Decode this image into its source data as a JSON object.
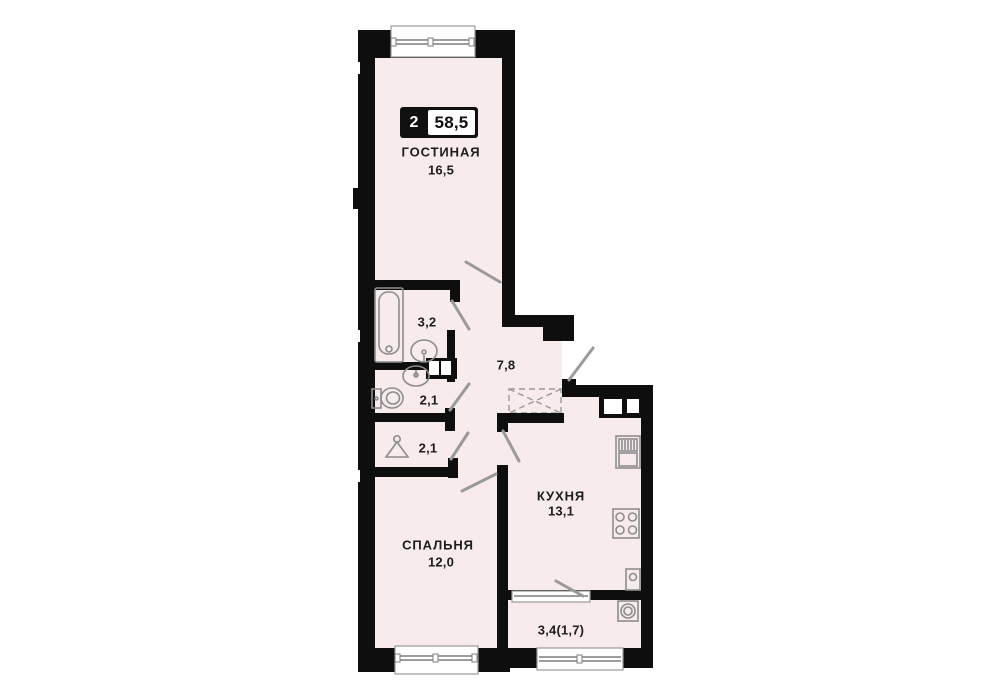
{
  "badge": {
    "rooms": "2",
    "total_area": "58,5"
  },
  "rooms": {
    "living": {
      "name": "ГОСТИНАЯ",
      "area": "16,5"
    },
    "bathroom": {
      "area": "3,2"
    },
    "hallway": {
      "area": "7,8"
    },
    "wc": {
      "area": "2,1"
    },
    "wardrobe": {
      "area": "2,1"
    },
    "bedroom": {
      "name": "СПАЛЬНЯ",
      "area": "12,0"
    },
    "kitchen": {
      "name": "КУХНЯ",
      "area": "13,1"
    },
    "balcony": {
      "area": "3,4(1,7)"
    }
  },
  "fixtures": [
    "bathtub-icon",
    "washbasin-icon",
    "washbasin-icon",
    "toilet-icon",
    "hanger-icon",
    "kitchen-sink-icon",
    "stove-icon",
    "boiler-icon",
    "washing-machine-icon",
    "wardrobe-niche",
    "vent-shaft"
  ],
  "colors": {
    "floor": "#f7ebeb",
    "wall": "#0e0e0e",
    "fixture_line": "#8d8d8d",
    "door_line": "#9a9a9a",
    "text": "#1d1d1d",
    "badge_bg": "#101010",
    "badge_value_bg": "#ffffff"
  }
}
